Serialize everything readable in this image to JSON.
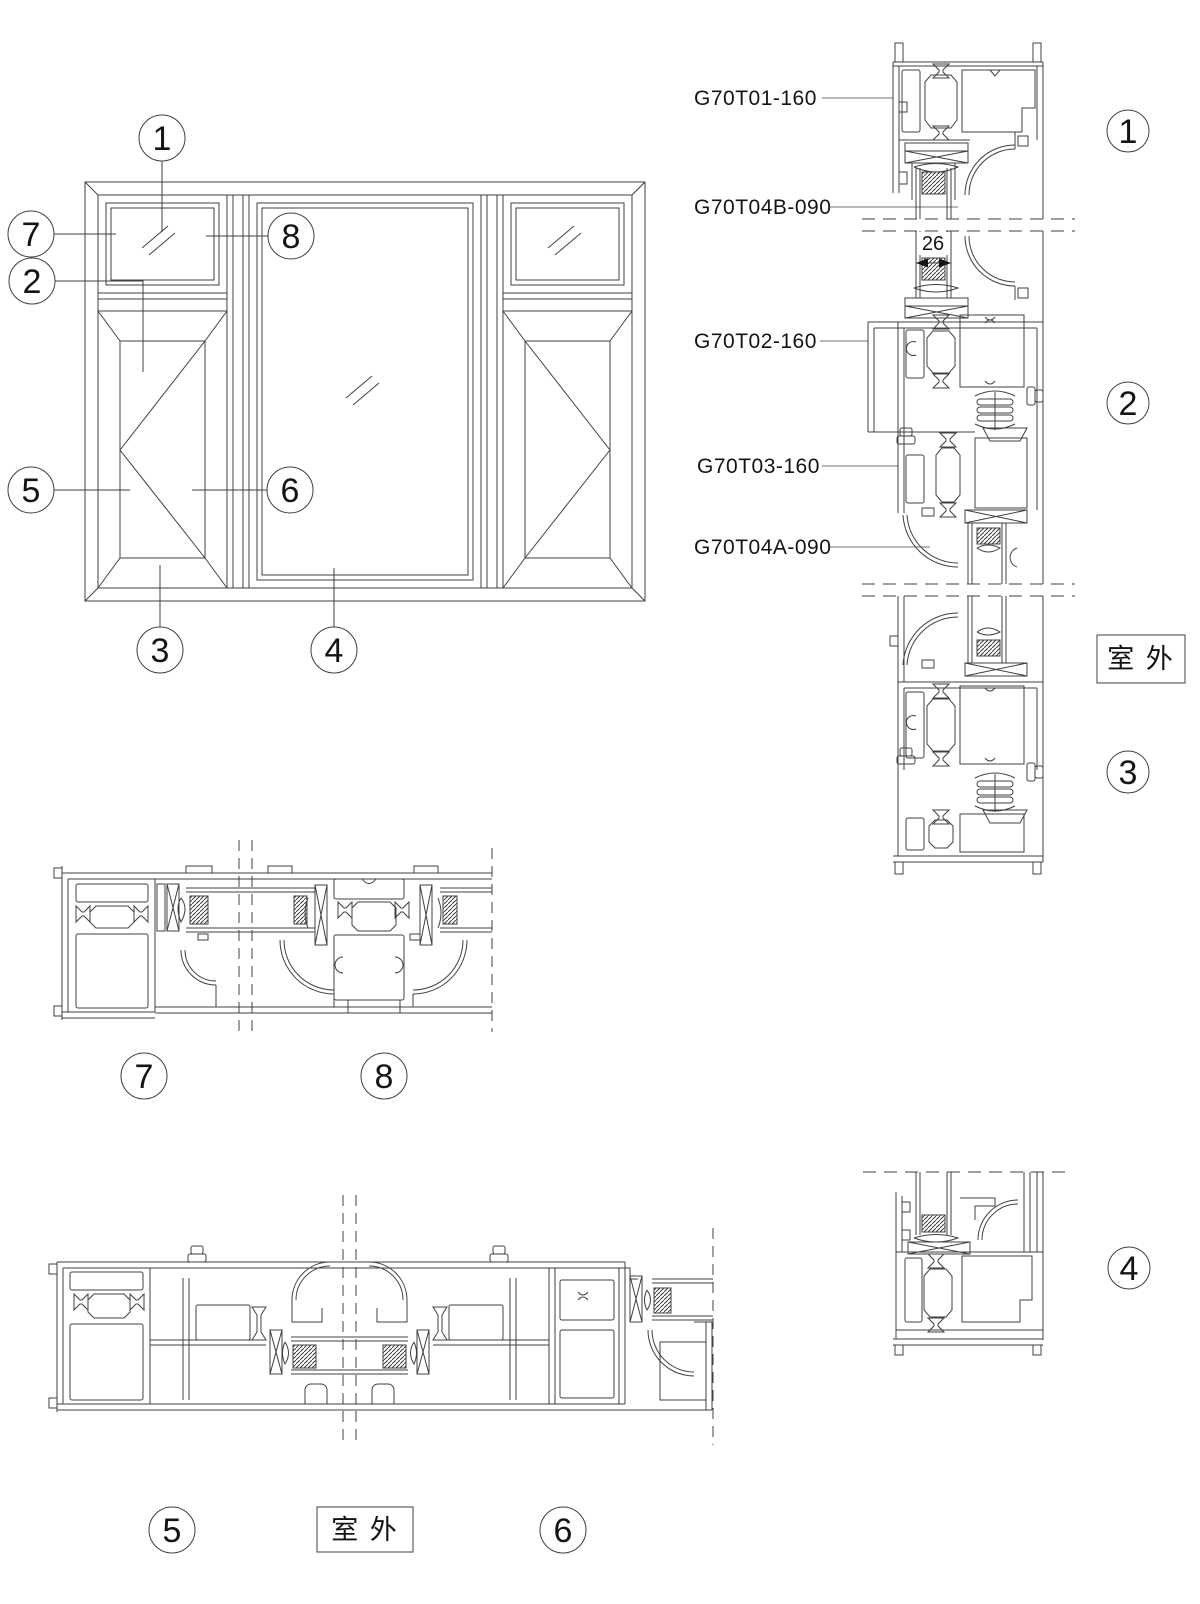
{
  "colors": {
    "line": "#404040",
    "text": "#141414",
    "background": "#ffffff"
  },
  "elevation_callouts": {
    "c1": "1",
    "c2": "2",
    "c3": "3",
    "c4": "4",
    "c5": "5",
    "c6": "6",
    "c7": "7",
    "c8": "8"
  },
  "section_marks": {
    "s1": "1",
    "s2": "2",
    "s3": "3",
    "s4": "4",
    "s5": "5",
    "s6": "6",
    "s7": "7",
    "s8": "8"
  },
  "part_labels": {
    "l1": "G70T01-160",
    "l2": "G70T04B-090",
    "l3": "G70T02-160",
    "l4": "G70T03-160",
    "l5": "G70T04A-090"
  },
  "dimensions": {
    "glass_thickness": "26"
  },
  "annotations": {
    "outdoor_right": "室 外",
    "outdoor_bottom": "室 外"
  }
}
